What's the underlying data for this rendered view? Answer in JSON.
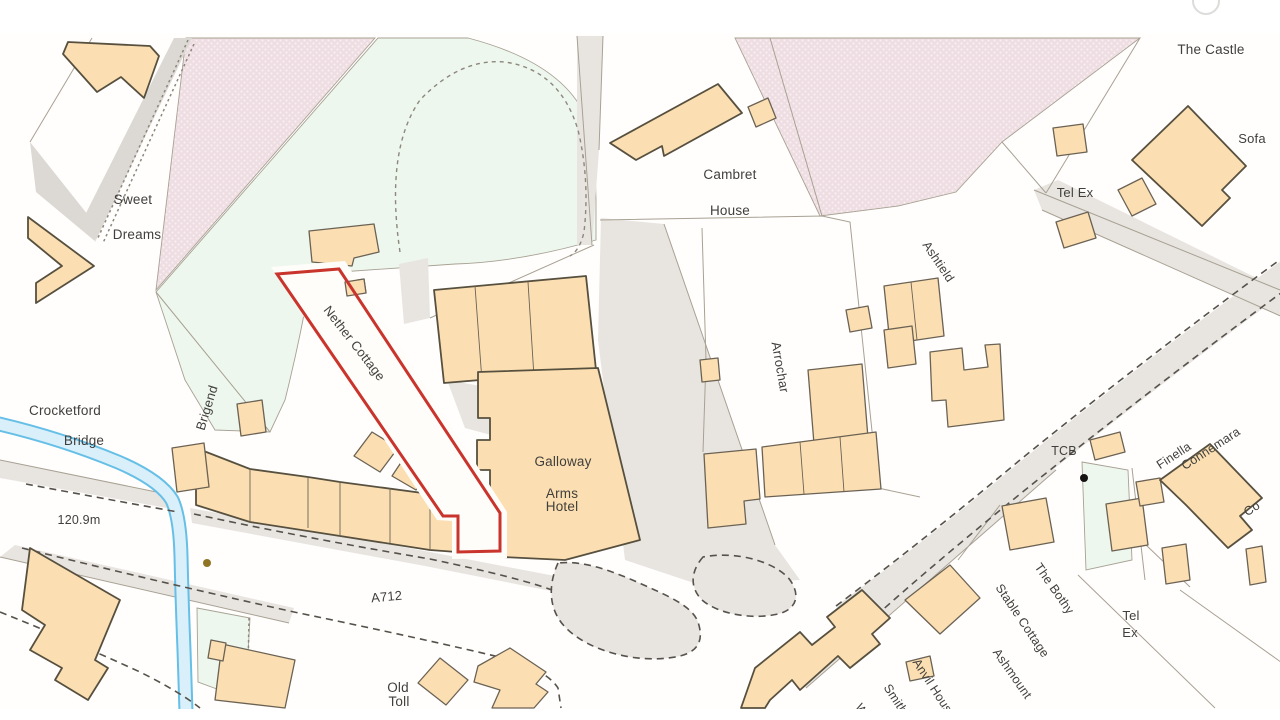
{
  "map": {
    "description": "Ordnance Survey style site location plan, Crocketford (A712)",
    "colors": {
      "building-fill": "#fbdfb2",
      "building-stroke": "#6b6254",
      "building-stroke-dark": "#57503f",
      "parcel-line": "#a8a193",
      "road-fill": "#e8e5e1",
      "road-fill-dark": "#dcd9d4",
      "green-fill": "#edf7ee",
      "pink-fill": "#eedde2",
      "pink-dot": "#f8f0f3",
      "stream-edge": "#66bfe6",
      "stream-fill": "#d9effa",
      "dash-line": "#56524b",
      "dot-line": "#8d877c",
      "site-boundary": "#c9342c",
      "label-text": "#413f3b",
      "road-label-text": "#55534e",
      "height-text": "#a08a2e"
    },
    "site": {
      "name": "Nether Cottage",
      "boundary_color": "#c9342c"
    },
    "labels": [
      {
        "id": "the-castle",
        "text": "The Castle",
        "x": 1211,
        "y": 54,
        "rotate": 0,
        "size": 13.5
      },
      {
        "id": "sofa",
        "text": "Sofa",
        "x": 1252,
        "y": 143,
        "rotate": 0,
        "size": 13
      },
      {
        "id": "tel-ex-north",
        "text": "Tel Ex",
        "x": 1075,
        "y": 197,
        "rotate": 0,
        "size": 13
      },
      {
        "id": "sweet",
        "text": "Sweet",
        "x": 133,
        "y": 204,
        "rotate": 0,
        "size": 13.5
      },
      {
        "id": "dreams",
        "text": "Dreams",
        "x": 137,
        "y": 239,
        "rotate": 0,
        "size": 13.5
      },
      {
        "id": "cambret",
        "text": "Cambret",
        "x": 730,
        "y": 179,
        "rotate": 0,
        "size": 13.5
      },
      {
        "id": "cambret-house",
        "text": "House",
        "x": 730,
        "y": 215,
        "rotate": 0,
        "size": 13.5
      },
      {
        "id": "ashtield",
        "text": "Ashtield",
        "x": 935,
        "y": 264,
        "rotate": 56,
        "size": 12.5
      },
      {
        "id": "arrochar",
        "text": "Arrochar",
        "x": 776,
        "y": 368,
        "rotate": 80,
        "size": 13
      },
      {
        "id": "nether-cottage",
        "text": "Nether Cottage",
        "x": 351,
        "y": 346,
        "rotate": 52,
        "size": 13
      },
      {
        "id": "galloway",
        "text": "Galloway",
        "x": 563,
        "y": 466,
        "rotate": 0,
        "size": 13.5
      },
      {
        "id": "arms",
        "text": "Arms",
        "x": 562,
        "y": 498,
        "rotate": 0,
        "size": 13.5
      },
      {
        "id": "hotel",
        "text": "Hotel",
        "x": 562,
        "y": 511,
        "rotate": 0,
        "size": 13.5
      },
      {
        "id": "crocketford",
        "text": "Crocketford",
        "x": 65,
        "y": 415,
        "rotate": 0,
        "size": 13.5
      },
      {
        "id": "bridge",
        "text": "Bridge",
        "x": 84,
        "y": 445,
        "rotate": 0,
        "size": 13.5
      },
      {
        "id": "brigend",
        "text": "Brigend",
        "x": 211,
        "y": 409,
        "rotate": -73,
        "size": 13
      },
      {
        "id": "spot-height",
        "text": "120.9m",
        "x": 79,
        "y": 524,
        "rotate": 0,
        "size": 12.5,
        "color": "#a08a2e"
      },
      {
        "id": "a712",
        "text": "A712",
        "x": 387,
        "y": 601,
        "rotate": -5,
        "size": 13,
        "color": "#55534e"
      },
      {
        "id": "old",
        "text": "Old",
        "x": 398,
        "y": 692,
        "rotate": 0,
        "size": 13.5
      },
      {
        "id": "toll",
        "text": "Toll",
        "x": 399,
        "y": 706,
        "rotate": 0,
        "size": 13.5
      },
      {
        "id": "tcb",
        "text": "TCB",
        "x": 1064,
        "y": 455,
        "rotate": 0,
        "size": 12.5
      },
      {
        "id": "finella",
        "text": "Finella",
        "x": 1176,
        "y": 459,
        "rotate": -33,
        "size": 12.5
      },
      {
        "id": "connemara",
        "text": "Connemara",
        "x": 1213,
        "y": 452,
        "rotate": -33,
        "size": 12.5
      },
      {
        "id": "co-partial",
        "text": "Co",
        "x": 1254,
        "y": 512,
        "rotate": -33,
        "size": 12.5
      },
      {
        "id": "the-bothy",
        "text": "The Bothy",
        "x": 1051,
        "y": 591,
        "rotate": 55,
        "size": 12.5
      },
      {
        "id": "stable-cottage",
        "text": "Stable Cottage",
        "x": 1019,
        "y": 623,
        "rotate": 56,
        "size": 12.5
      },
      {
        "id": "ashmount",
        "text": "Ashmount",
        "x": 1009,
        "y": 676,
        "rotate": 55,
        "size": 12.5
      },
      {
        "id": "tel-ex-south-line1",
        "text": "Tel",
        "x": 1131,
        "y": 620,
        "rotate": 0,
        "size": 13
      },
      {
        "id": "tel-ex-south-line2",
        "text": "Ex",
        "x": 1130,
        "y": 637,
        "rotate": 0,
        "size": 13
      },
      {
        "id": "anvil-house",
        "text": "Anvil House",
        "x": 931,
        "y": 691,
        "rotate": 57,
        "size": 12.5
      },
      {
        "id": "smithy",
        "text": "Smithy",
        "x": 894,
        "y": 704,
        "rotate": 57,
        "size": 12.5
      },
      {
        "id": "w-partial",
        "text": "W",
        "x": 858,
        "y": 712,
        "rotate": 57,
        "size": 12.5
      }
    ],
    "markers": [
      {
        "id": "spot-height-dot",
        "x": 207,
        "y": 563,
        "r": 4,
        "color": "#8f7523"
      },
      {
        "id": "tcb-point-dot",
        "x": 1084,
        "y": 478,
        "r": 4,
        "color": "#161412"
      }
    ]
  }
}
